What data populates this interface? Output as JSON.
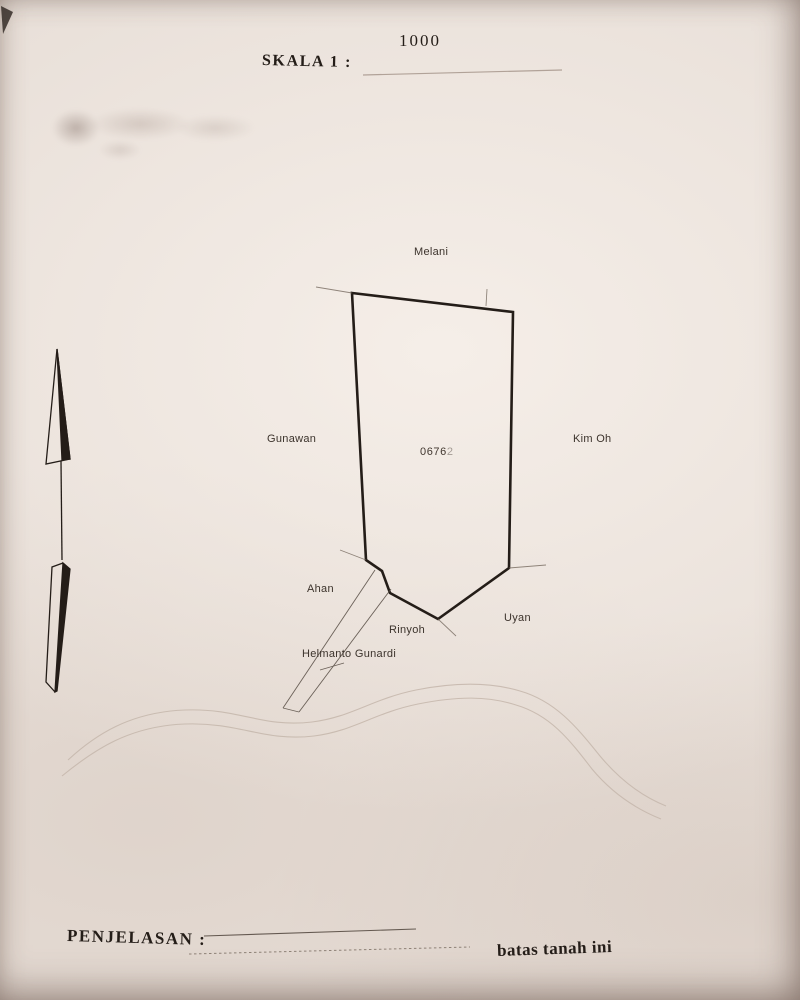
{
  "document_kind": "scanned land survey sketch (surat ukur sketch)",
  "colors": {
    "paper": "#e8dfd8",
    "ink": "#29211c",
    "label_text": "#3c332c",
    "faint_line": "#8d8076",
    "river_line": "#c7b9ae"
  },
  "header": {
    "scale_label": "SKALA  1  :",
    "scale_value": "1000"
  },
  "map": {
    "parcel_number_main": "0676",
    "parcel_number_faded": "2",
    "neighbors": {
      "north": "Melani",
      "west": "Gunawan",
      "east": "Kim Oh",
      "southwest": "Ahan",
      "south": "Rinyoh",
      "southeast": "Uyan"
    },
    "road_label": "Helmanto Gunardi",
    "symbols": {
      "north_arrow": "north-arrow",
      "access_road": "hatched road strip",
      "river": "faint double wavy line"
    }
  },
  "footer": {
    "label": "PENJELASAN  :",
    "note": "batas tanah ini"
  }
}
